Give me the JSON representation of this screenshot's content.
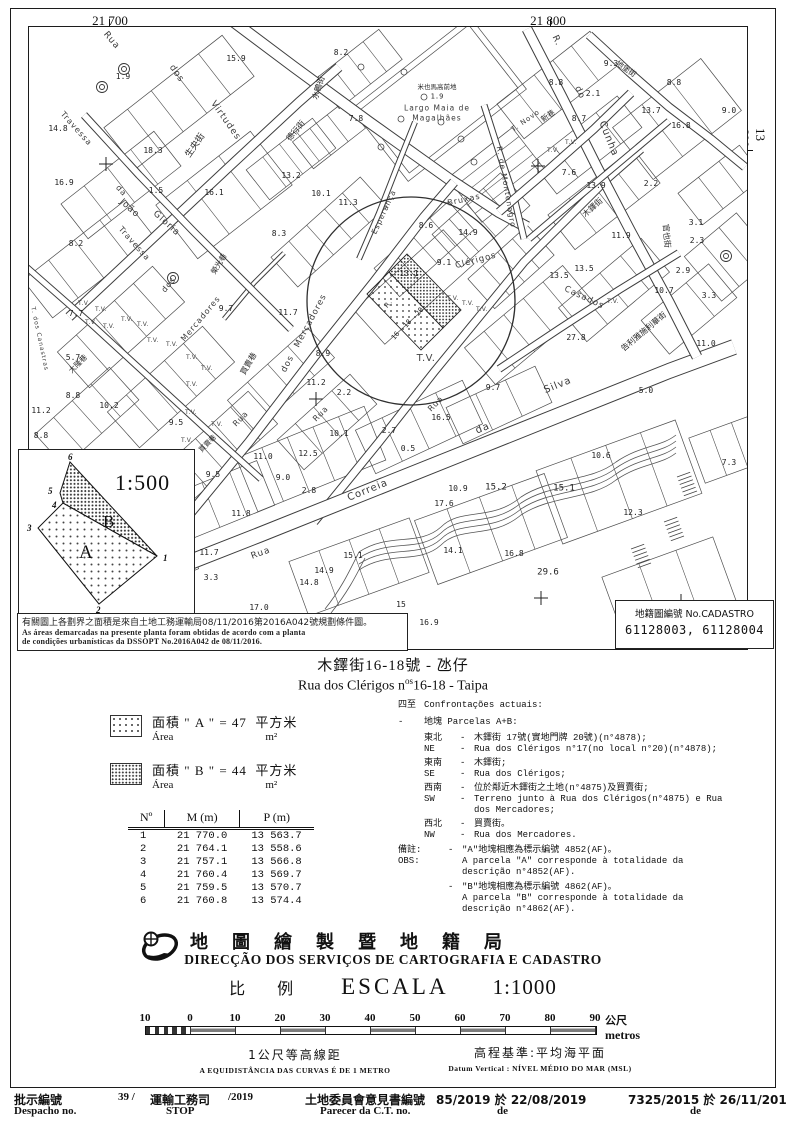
{
  "frame": {
    "coord_top_left": "21 700",
    "coord_top_right": "21 800",
    "coord_right": "13 600"
  },
  "map": {
    "tv_label": "T.V.",
    "labels": [
      [
        "Rua",
        82,
        14,
        50,
        9,
        "st"
      ],
      [
        "dos",
        147,
        47,
        55,
        9,
        "st"
      ],
      [
        "Virtudes",
        196,
        94,
        55,
        9,
        "st"
      ],
      [
        "生央街",
        167,
        119,
        -55,
        9,
        "zh"
      ],
      [
        "德行街",
        267,
        104,
        -50,
        8,
        "zh"
      ],
      [
        "水鴨街",
        290,
        61,
        -72,
        8,
        "zh"
      ],
      [
        "米也馬高前地",
        408,
        60,
        0,
        6.5,
        "zh"
      ],
      [
        "1.9",
        408,
        70,
        0,
        7,
        "spot"
      ],
      [
        "Largo Maia de",
        408,
        81,
        0,
        7.5,
        "st"
      ],
      [
        "Magalhães",
        408,
        91,
        0,
        7.5,
        "st"
      ],
      [
        "Travessa",
        47,
        102,
        48,
        8,
        "st"
      ],
      [
        "da",
        92,
        164,
        48,
        8,
        "st"
      ],
      [
        "João",
        100,
        182,
        42,
        9,
        "st"
      ],
      [
        "Gloria",
        137,
        197,
        42,
        9,
        "st"
      ],
      [
        "Travessa",
        105,
        217,
        48,
        8,
        "st"
      ],
      [
        "dos",
        140,
        258,
        -50,
        8,
        "st"
      ],
      [
        "Mercadores",
        172,
        292,
        -50,
        8,
        "st"
      ],
      [
        "Mercadores",
        282,
        294,
        -62,
        8.5,
        "st"
      ],
      [
        "dos",
        259,
        337,
        -62,
        8.5,
        "st"
      ],
      [
        "榮光巷",
        190,
        237,
        -58,
        7.5,
        "zh"
      ],
      [
        "買賣巷",
        220,
        337,
        -60,
        8,
        "zh"
      ],
      [
        "買賣巷",
        179,
        417,
        -45,
        7,
        "zh"
      ],
      [
        "T. dos Canastras",
        10,
        312,
        78,
        6,
        "st"
      ],
      [
        "大隆巷",
        49,
        337,
        -45,
        7.5,
        "zh"
      ],
      [
        "Esperança",
        355,
        185,
        -65,
        7.5,
        "st"
      ],
      [
        "Bruxas",
        435,
        173,
        -12,
        8,
        "st"
      ],
      [
        "R. de Montenegro",
        477,
        160,
        80,
        7.5,
        "st"
      ],
      [
        "T. Novo",
        497,
        94,
        -35,
        7,
        "st"
      ],
      [
        "新巷",
        519,
        89,
        -35,
        7.5,
        "zh"
      ],
      [
        "R.",
        527,
        14,
        65,
        9,
        "st"
      ],
      [
        "do",
        550,
        66,
        65,
        9,
        "st"
      ],
      [
        "Cunha",
        579,
        112,
        68,
        10,
        "st"
      ],
      [
        "地堡街",
        597,
        42,
        35,
        7.5,
        "zh"
      ],
      [
        "官也街",
        637,
        209,
        85,
        8,
        "zh"
      ],
      [
        "木鐸街",
        564,
        181,
        -42,
        8,
        "zh"
      ],
      [
        "Clérigos",
        447,
        234,
        -15,
        8.5,
        "st"
      ],
      [
        "Casados",
        555,
        271,
        25,
        8.5,
        "st"
      ],
      [
        "Rua",
        232,
        527,
        -20,
        9,
        "st"
      ],
      [
        "Correia",
        339,
        464,
        -22,
        10,
        "st"
      ],
      [
        "da",
        454,
        402,
        -22,
        10,
        "st"
      ],
      [
        "Silva",
        529,
        359,
        -22,
        10,
        "st"
      ],
      [
        "告利雅施利華街",
        615,
        305,
        -40,
        8,
        "zh"
      ],
      [
        "Rua",
        212,
        392,
        -45,
        8,
        "st"
      ],
      [
        "Rua",
        292,
        387,
        -45,
        8,
        "st"
      ],
      [
        "Rua",
        407,
        377,
        -45,
        8,
        "st"
      ],
      [
        "R.",
        360,
        277,
        -50,
        7,
        "st"
      ],
      [
        "16",
        367,
        309,
        -50,
        7,
        "spot"
      ],
      [
        "18",
        379,
        297,
        -50,
        7,
        "spot"
      ],
      [
        "20",
        391,
        285,
        -50,
        7,
        "spot"
      ],
      [
        "T.V.",
        397,
        332,
        0,
        10,
        "tv"
      ],
      [
        "15.9",
        207,
        32,
        0,
        8,
        "spot"
      ],
      [
        "1.9",
        94,
        50,
        0,
        8,
        "spot"
      ],
      [
        "8.2",
        312,
        26,
        0,
        8,
        "spot"
      ],
      [
        "14.8",
        29,
        102,
        0,
        8,
        "spot"
      ],
      [
        "18.3",
        124,
        124,
        0,
        8,
        "spot"
      ],
      [
        "16.9",
        35,
        156,
        0,
        8,
        "spot"
      ],
      [
        "1.5",
        127,
        164,
        0,
        8,
        "spot"
      ],
      [
        "16.1",
        185,
        166,
        0,
        8,
        "spot"
      ],
      [
        "13.2",
        262,
        149,
        0,
        8,
        "spot"
      ],
      [
        "10.1",
        292,
        167,
        0,
        8,
        "spot"
      ],
      [
        "11.3",
        319,
        176,
        0,
        8,
        "spot"
      ],
      [
        "8.3",
        250,
        207,
        0,
        8,
        "spot"
      ],
      [
        "7.8",
        327,
        92,
        0,
        8,
        "spot"
      ],
      [
        "8.2",
        47,
        217,
        0,
        8,
        "spot"
      ],
      [
        "7.7",
        47,
        287,
        0,
        8,
        "spot"
      ],
      [
        "5.7",
        44,
        331,
        0,
        8,
        "spot"
      ],
      [
        "8.8",
        44,
        369,
        0,
        8,
        "spot"
      ],
      [
        "10.2",
        80,
        379,
        0,
        8,
        "spot"
      ],
      [
        "11.2",
        12,
        384,
        0,
        8,
        "spot"
      ],
      [
        "8.8",
        12,
        409,
        0,
        8,
        "spot"
      ],
      [
        "9.5",
        147,
        396,
        0,
        8,
        "spot"
      ],
      [
        "9.7",
        197,
        282,
        0,
        8,
        "spot"
      ],
      [
        "11.7",
        259,
        286,
        0,
        8,
        "spot"
      ],
      [
        "8.9",
        294,
        327,
        0,
        8,
        "spot"
      ],
      [
        "11.2",
        287,
        356,
        0,
        8,
        "spot"
      ],
      [
        "2.2",
        315,
        366,
        0,
        8,
        "spot"
      ],
      [
        "13.1",
        380,
        247,
        0,
        8,
        "spot"
      ],
      [
        "9.1",
        415,
        236,
        0,
        8,
        "spot"
      ],
      [
        "14.9",
        439,
        206,
        0,
        8,
        "spot"
      ],
      [
        "8.6",
        397,
        199,
        0,
        8,
        "spot"
      ],
      [
        "9.3",
        582,
        37,
        0,
        8,
        "spot"
      ],
      [
        "8.8",
        527,
        56,
        0,
        8,
        "spot"
      ],
      [
        "2.1",
        564,
        67,
        0,
        8,
        "spot"
      ],
      [
        "8.7",
        550,
        92,
        0,
        8,
        "spot"
      ],
      [
        "13.7",
        622,
        84,
        0,
        8,
        "spot"
      ],
      [
        "8.8",
        645,
        56,
        0,
        8,
        "spot"
      ],
      [
        "9.0",
        700,
        84,
        0,
        8,
        "spot"
      ],
      [
        "16.8",
        652,
        99,
        0,
        8,
        "spot"
      ],
      [
        "7.6",
        540,
        146,
        0,
        8,
        "spot"
      ],
      [
        "13.9",
        567,
        159,
        0,
        8,
        "spot"
      ],
      [
        "2.2",
        622,
        157,
        0,
        8,
        "spot"
      ],
      [
        "3.1",
        667,
        196,
        0,
        8,
        "spot"
      ],
      [
        "11.9",
        592,
        209,
        0,
        8,
        "spot"
      ],
      [
        "13.5",
        555,
        242,
        0,
        8,
        "spot"
      ],
      [
        "13.5",
        530,
        249,
        0,
        8,
        "spot"
      ],
      [
        "2.9",
        654,
        244,
        0,
        8,
        "spot"
      ],
      [
        "10.7",
        635,
        264,
        0,
        8,
        "spot"
      ],
      [
        "3.3",
        680,
        269,
        0,
        8,
        "spot"
      ],
      [
        "11.0",
        677,
        317,
        0,
        8,
        "spot"
      ],
      [
        "5.0",
        617,
        364,
        0,
        8,
        "spot"
      ],
      [
        "27.8",
        547,
        311,
        0,
        8,
        "spot"
      ],
      [
        "9.7",
        464,
        361,
        0,
        8,
        "spot"
      ],
      [
        "16.5",
        412,
        391,
        0,
        8,
        "spot"
      ],
      [
        "2.7",
        360,
        404,
        0,
        8,
        "spot"
      ],
      [
        "0.5",
        379,
        422,
        0,
        8,
        "spot"
      ],
      [
        "10.1",
        310,
        407,
        0,
        8,
        "spot"
      ],
      [
        "12.5",
        279,
        427,
        0,
        8,
        "spot"
      ],
      [
        "11.0",
        234,
        430,
        0,
        8,
        "spot"
      ],
      [
        "9.0",
        254,
        451,
        0,
        8,
        "spot"
      ],
      [
        "9.5",
        184,
        448,
        0,
        8,
        "spot"
      ],
      [
        "2.8",
        280,
        464,
        0,
        8,
        "spot"
      ],
      [
        "11.8",
        212,
        487,
        0,
        8,
        "spot"
      ],
      [
        "11.7",
        180,
        526,
        0,
        8,
        "spot"
      ],
      [
        "3.3",
        182,
        551,
        0,
        8,
        "spot"
      ],
      [
        "17.0",
        230,
        581,
        0,
        8,
        "spot"
      ],
      [
        "15.1",
        324,
        529,
        0,
        8,
        "spot"
      ],
      [
        "14.9",
        295,
        544,
        0,
        8,
        "spot"
      ],
      [
        "14.8",
        280,
        556,
        0,
        8,
        "spot"
      ],
      [
        "14.1",
        424,
        524,
        0,
        8,
        "spot"
      ],
      [
        "16.8",
        485,
        527,
        0,
        8,
        "spot"
      ],
      [
        "29.6",
        519,
        546,
        0,
        9,
        "spot"
      ],
      [
        "15.2",
        467,
        461,
        0,
        9,
        "spot"
      ],
      [
        "15.1",
        535,
        462,
        0,
        9,
        "spot"
      ],
      [
        "10.9",
        429,
        462,
        0,
        8,
        "spot"
      ],
      [
        "17.6",
        415,
        477,
        0,
        8,
        "spot"
      ],
      [
        "10.6",
        572,
        429,
        0,
        8,
        "spot"
      ],
      [
        "12.3",
        604,
        486,
        0,
        8,
        "spot"
      ],
      [
        "7.3",
        700,
        436,
        0,
        8,
        "spot"
      ],
      [
        "16.9",
        400,
        596,
        0,
        8,
        "spot"
      ],
      [
        "34.9",
        330,
        614,
        0,
        8,
        "spot"
      ],
      [
        "15",
        372,
        578,
        0,
        8,
        "spot"
      ],
      [
        "2.3",
        668,
        214,
        0,
        8,
        "spot"
      ],
      [
        "T.V.",
        55,
        277,
        0,
        6,
        "tv"
      ],
      [
        "T.V.",
        72,
        283,
        0,
        6,
        "tv"
      ],
      [
        "T.V.",
        62,
        296,
        0,
        6,
        "tv"
      ],
      [
        "T.V.",
        80,
        300,
        0,
        6,
        "tv"
      ],
      [
        "T.V.",
        98,
        293,
        0,
        6,
        "tv"
      ],
      [
        "T.V.",
        114,
        298,
        0,
        6,
        "tv"
      ],
      [
        "T.V.",
        124,
        314,
        0,
        6,
        "tv"
      ],
      [
        "T.V.",
        143,
        318,
        0,
        6,
        "tv"
      ],
      [
        "T.V.",
        163,
        331,
        0,
        6,
        "tv"
      ],
      [
        "T.V.",
        178,
        342,
        0,
        6,
        "tv"
      ],
      [
        "T.V.",
        163,
        358,
        0,
        6,
        "tv"
      ],
      [
        "T.V.",
        188,
        398,
        0,
        6,
        "tv"
      ],
      [
        "T.V.",
        158,
        414,
        0,
        6,
        "tv"
      ],
      [
        "T.V.",
        424,
        272,
        0,
        6,
        "tv"
      ],
      [
        "T.V.",
        439,
        277,
        0,
        6,
        "tv"
      ],
      [
        "T.V.",
        453,
        283,
        0,
        6,
        "tv"
      ],
      [
        "T.V.",
        542,
        116,
        0,
        6,
        "tv"
      ],
      [
        "T.V.",
        524,
        124,
        0,
        6,
        "tv"
      ],
      [
        "T.V.",
        584,
        275,
        0,
        6,
        "tv"
      ],
      [
        "T.V.",
        162,
        386,
        0,
        6,
        "tv"
      ]
    ]
  },
  "inset": {
    "scale": "1:500",
    "label_a": "A",
    "label_b": "B",
    "vertices": [
      "1",
      "2",
      "3",
      "4",
      "5",
      "6"
    ]
  },
  "note": {
    "zh": "有關圖上各劃界之面積是來自土地工務運輸局08/11/2016第2016A042號規劃條件圖。",
    "pt1": "As áreas demarcadas na presente planta foram obtidas de acordo com a planta",
    "pt2": "de condições urbanísticas da DSSOPT No.2016A042 de 08/11/2016."
  },
  "cadastro": {
    "label": "地籍圖編號 No.CADASTRO",
    "numbers": "61128003, 61128004"
  },
  "title": {
    "zh": "木鐸街16-18號 - 氹仔",
    "pt_prefix": "Rua dos Clérigos n",
    "pt_sup": "os",
    "pt_suffix": "16-18 - Taipa"
  },
  "areas": {
    "zh_label": "面積",
    "pt_label": "Área",
    "unit_zh": "平方米",
    "unit_pt": "m²",
    "a_name": "\" A \"",
    "a_value": "= 47",
    "b_name": "\" B \"",
    "b_value": "= 44"
  },
  "table": {
    "headers": [
      "Nº",
      "M (m)",
      "P (m)"
    ],
    "rows": [
      [
        "1",
        "21 770.0",
        "13 563.7"
      ],
      [
        "2",
        "21 764.1",
        "13 558.6"
      ],
      [
        "3",
        "21 757.1",
        "13 566.8"
      ],
      [
        "4",
        "21 760.4",
        "13 569.7"
      ],
      [
        "5",
        "21 759.5",
        "13 570.7"
      ],
      [
        "6",
        "21 760.8",
        "13 574.4"
      ]
    ]
  },
  "confront": {
    "heading_zh": "四至",
    "heading_pt": "Confrontações actuais:",
    "bullet": "-",
    "parcels_line": "地塊 Parcelas A+B:",
    "rows": [
      {
        "zh_dir": "東北",
        "zh": "木鐸街 17號(實地門牌 20號)(n°4878);",
        "pt_dir": "NE",
        "pt": "Rua dos Clérigos n°17(no local n°20)(n°4878);"
      },
      {
        "zh_dir": "東南",
        "zh": "木鐸街;",
        "pt_dir": "SE",
        "pt": "Rua dos Clérigos;"
      },
      {
        "zh_dir": "西南",
        "zh": "位於鄰近木鐸街之土地(n°4875)及買賣街;",
        "pt_dir": "SW",
        "pt": "Terreno junto à Rua dos Clérigos(n°4875) e Rua\ndos Mercadores;"
      },
      {
        "zh_dir": "西北",
        "zh": "買賣街。",
        "pt_dir": "NW",
        "pt": "Rua dos Mercadores."
      }
    ]
  },
  "obs": {
    "zh_label": "備註:",
    "pt_label": "OBS:",
    "bullet": "-",
    "items": [
      {
        "zh": "\"A\"地塊相應為標示編號 4852(AF)。",
        "pt": "A parcela \"A\" corresponde à totalidade da\ndescrição n°4852(AF)."
      },
      {
        "zh": "\"B\"地塊相應為標示編號 4862(AF)。",
        "pt": "A parcela \"B\" corresponde à totalidade da\ndescrição n°4862(AF)."
      }
    ]
  },
  "agency": {
    "zh": "地圖繪製暨地籍局",
    "pt": "DIRECÇÃO DOS SERVIÇOS DE CARTOGRAFIA E CADASTRO",
    "scale_zh": "比 例",
    "scale_pt": "ESCALA",
    "scale_value": "1:1000"
  },
  "scalebar": {
    "ticks": [
      "10",
      "0",
      "10",
      "20",
      "30",
      "40",
      "50",
      "60",
      "70",
      "80",
      "90"
    ],
    "unit_zh": "公尺",
    "unit_pt": "metros",
    "left_zh": "1公尺等高線距",
    "left_pt": "A EQUIDISTÂNCIA DAS CURVAS É DE 1 METRO",
    "right_zh": "高程基準:平均海平面",
    "right_pt": "Datum Vertical : NÍVEL MÉDIO DO MAR (MSL)"
  },
  "footer": {
    "despacho_zh": "批示編號",
    "despacho_pt": "Despacho no.",
    "despacho_v1": "39 /",
    "despacho_v2": "運輸工務司",
    "despacho_v2b": "STOP",
    "despacho_v3": "/2019",
    "parecer_zh": "土地委員會意見書編號",
    "parecer_pt": "Parecer da C.T. no.",
    "parecer_value": "85/2019 於 22/08/2019",
    "parecer_de": "de",
    "right_value": "7325/2015 於 26/11/2018",
    "right_de": "de"
  }
}
